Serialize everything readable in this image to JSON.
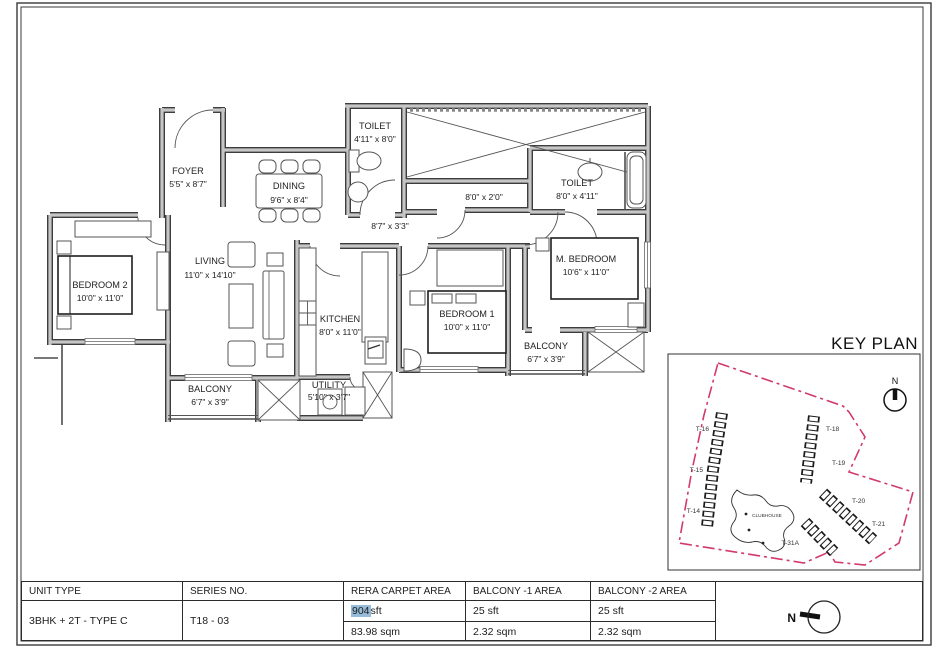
{
  "floor_plan": {
    "rooms": {
      "foyer": {
        "name": "FOYER",
        "dims": "5'5\" x 8'7\""
      },
      "dining": {
        "name": "DINING",
        "dims": "9'6\" x 8'4\""
      },
      "toilet1": {
        "name": "TOILET",
        "dims": "4'11\" x 8'0\""
      },
      "toilet2": {
        "name": "TOILET",
        "dims": "8'0\" x 4'11\""
      },
      "living": {
        "name": "LIVING",
        "dims": "11'0\" x 14'10\""
      },
      "bedroom2": {
        "name": "BEDROOM 2",
        "dims": "10'0\" x 11'0\""
      },
      "kitchen": {
        "name": "KITCHEN",
        "dims": "8'0\" x 11'0\""
      },
      "bedroom1": {
        "name": "BEDROOM 1",
        "dims": "10'0\" x 11'0\""
      },
      "master": {
        "name": "M. BEDROOM",
        "dims": "10'6\" x 11'0\""
      },
      "balcony1": {
        "name": "BALCONY",
        "dims": "6'7\" x 3'9\""
      },
      "balcony2": {
        "name": "BALCONY",
        "dims": "6'7\" x 3'9\""
      },
      "utility": {
        "name": "UTILITY",
        "dims": "5'10\" x 3'7\""
      }
    },
    "passages": {
      "p1": "8'7\" x 3'3\"",
      "p2": "8'0\" x 2'0\""
    }
  },
  "key_plan": {
    "title": "KEY PLAN",
    "north_label": "N",
    "boundary_color": "#d23a6c",
    "towers": {
      "t16": "T-16",
      "t15": "T-15",
      "t14": "T-14",
      "t18": "T-18",
      "t19": "T-19",
      "t20": "T-20",
      "t21": "T-21",
      "t31a": "T-31A"
    },
    "clubhouse": "CLUBHOUSE"
  },
  "area_table": {
    "headers": {
      "unit_type": "UNIT TYPE",
      "series_no": "SERIES NO.",
      "rera": "RERA CARPET AREA",
      "balcony1": "BALCONY -1  AREA",
      "balcony2": "BALCONY -2  AREA"
    },
    "unit_type": "3BHK + 2T - TYPE C",
    "series_no": "T18 - 03",
    "rera_sft_value": "904",
    "rera_sft_unit": " sft",
    "rera_sqm": "83.98 sqm",
    "balcony1_sft": "25 sft",
    "balcony1_sqm": "2.32 sqm",
    "balcony2_sft": "25 sft",
    "balcony2_sqm": "2.32 sqm",
    "highlight_color": "#96bcd9"
  },
  "compass": {
    "label": "N"
  }
}
